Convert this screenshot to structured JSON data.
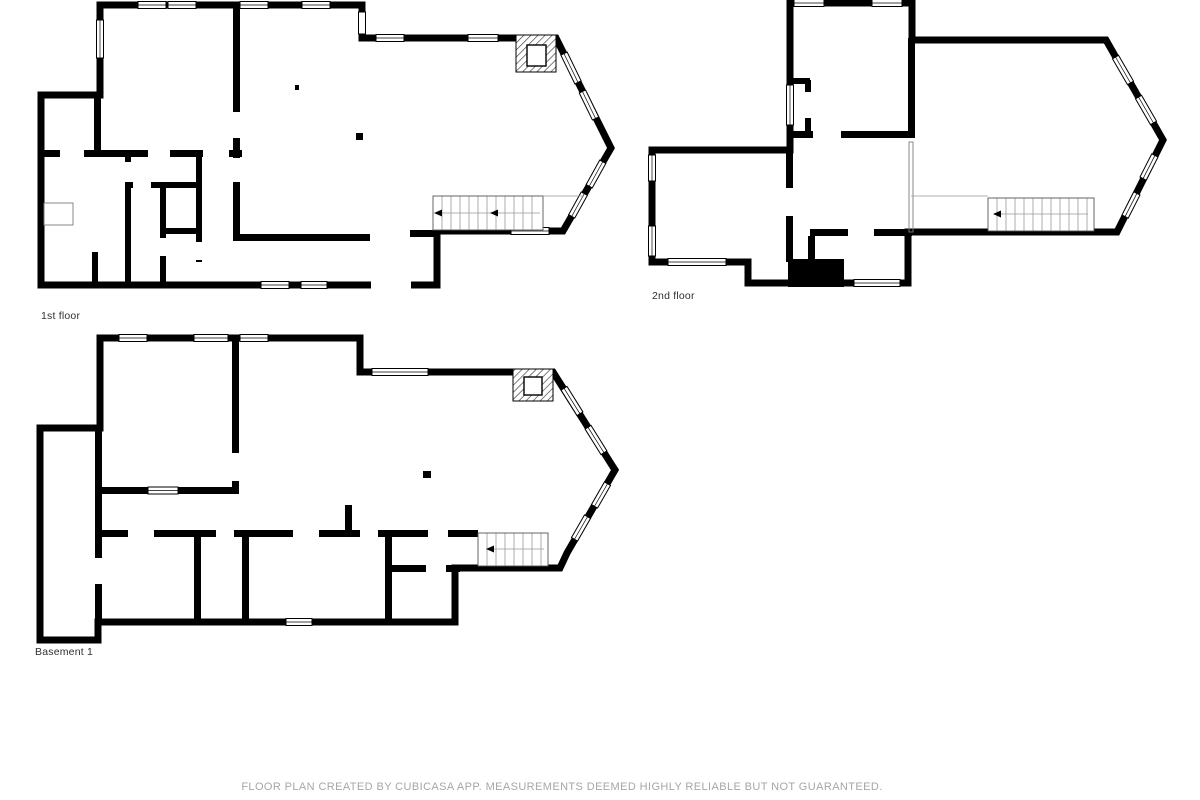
{
  "footer": "FLOOR PLAN CREATED BY CUBICASA APP. MEASUREMENTS DEEMED HIGHLY RELIABLE BUT NOT GUARANTEED.",
  "colors": {
    "wall": "#000000",
    "room_text": "#3d3d3d",
    "footer_text": "#a6a6a6",
    "background": "#ffffff"
  },
  "floors": [
    {
      "label": "1st floor",
      "rooms": [
        {
          "name": "PRIMARY BEDROOM",
          "dims": "4.11 m x 4.62 m"
        },
        {
          "name": "DINING AREA",
          "dims": "3.90 m x 2.68 m"
        },
        {
          "name": "W.I.C.",
          "dims": "1.80 m x 1.75 m"
        },
        {
          "name": "BATH",
          "dims": "3.81 m x 4.09 m"
        },
        {
          "name": "LAUNDRY",
          "dims": "1.75 m x 1.69 m"
        },
        {
          "name": "HALL",
          "dims": "0.97 m x 2.64 m"
        },
        {
          "name": "BATH",
          "dims": "1.19 m x 2.55 m"
        },
        {
          "name": "BATH",
          "dims": "1.75 m x 1.60 m"
        },
        {
          "name": "KITCHEN",
          "dims": "3.90 m x 4.60 m"
        },
        {
          "name": "LIVING ROOM",
          "dims": "7.88 m x 6.19 m"
        },
        {
          "name": "HALL",
          "dims": "4.97 m x 1.43 m"
        },
        {
          "name": "FOYER",
          "dims": "2.28 m x 1.44 m"
        }
      ]
    },
    {
      "label": "2nd floor",
      "annotation": "OPEN TO BELOW",
      "rooms": [
        {
          "name": "BEDROOM",
          "dims": "3.85 m x 4.08 m"
        },
        {
          "name": "BEDROOM",
          "dims": "4.11 m x 3.44 m"
        },
        {
          "name": "HALL",
          "dims": "6.30 m x 2.93 m"
        },
        {
          "name": "BATH",
          "dims": "2.90 m x 1.60 m"
        }
      ]
    },
    {
      "label": "Basement 1",
      "rooms": [
        {
          "name": "BEDROOM",
          "dims": "4.10 m x 4.56 m"
        },
        {
          "name": "RECREATION ROOM",
          "dims": "11.52 m x 4.82 m"
        },
        {
          "name": "WET BAR",
          "dims": "4.61 m x 2.01 m"
        },
        {
          "name": "STORAGE",
          "dims": "1.82 m x 5.94 m"
        },
        {
          "name": "HALL",
          "dims": "8.05 m x 1.81 m"
        },
        {
          "name": "ROOM",
          "dims": "2.88 m x 2.70 m"
        },
        {
          "name": "BATH",
          "dims": "1.51 m x 2.74 m"
        },
        {
          "name": "BEDROOM",
          "dims": "4.35 m x 2.69 m"
        },
        {
          "name": "HALL",
          "dims": "1.99 m x 1.11 m"
        },
        {
          "name": "BATH",
          "dims": "1.99 m x 1.60 m"
        }
      ]
    }
  ]
}
